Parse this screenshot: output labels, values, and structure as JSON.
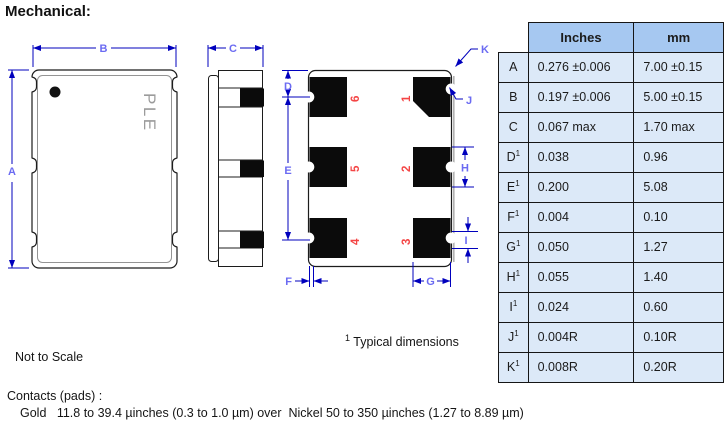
{
  "title": "Mechanical:",
  "drawings": {
    "marking": "PLE",
    "dim_labels": {
      "A": "A",
      "B": "B",
      "C": "C",
      "D": "D",
      "E": "E",
      "F": "F",
      "G": "G",
      "H": "H",
      "I": "I",
      "J": "J",
      "K": "K"
    },
    "pad_numbers": {
      "n1": "1",
      "n2": "2",
      "n3": "3",
      "n4": "4",
      "n5": "5",
      "n6": "6"
    }
  },
  "table": {
    "col_headers": [
      "Inches",
      "mm"
    ],
    "rows": [
      {
        "label": "A",
        "sup": "",
        "inches": "0.276 ±0.006",
        "mm": "7.00 ±0.15"
      },
      {
        "label": "B",
        "sup": "",
        "inches": "0.197 ±0.006",
        "mm": "5.00 ±0.15"
      },
      {
        "label": "C",
        "sup": "",
        "inches": "0.067 max",
        "mm": "1.70 max"
      },
      {
        "label": "D",
        "sup": "1",
        "inches": "0.038",
        "mm": "0.96"
      },
      {
        "label": "E",
        "sup": "1",
        "inches": "0.200",
        "mm": "5.08"
      },
      {
        "label": "F",
        "sup": "1",
        "inches": "0.004",
        "mm": "0.10"
      },
      {
        "label": "G",
        "sup": "1",
        "inches": "0.050",
        "mm": "1.27"
      },
      {
        "label": "H",
        "sup": "1",
        "inches": "0.055",
        "mm": "1.40"
      },
      {
        "label": "I",
        "sup": "1",
        "inches": "0.024",
        "mm": "0.60"
      },
      {
        "label": "J",
        "sup": "1",
        "inches": "0.004R",
        "mm": "0.10R"
      },
      {
        "label": "K",
        "sup": "1",
        "inches": "0.008R",
        "mm": "0.20R"
      }
    ]
  },
  "notes": {
    "typical_sup": "1",
    "typical": " Typical dimensions",
    "not_to_scale": "Not to Scale",
    "contacts_heading": "Contacts (pads) :",
    "contacts_detail": "Gold   11.8 to 39.4 µinches (0.3 to 1.0 µm) over  Nickel 50 to 350 µinches (1.27 to 8.89 µm)"
  },
  "colors": {
    "dim_line": "#0000bd",
    "dim_label": "#6b6bf2",
    "pad_number": "#f44545",
    "table_header_bg": "#a6c8f1",
    "table_cell_bg": "#dce9f8"
  }
}
